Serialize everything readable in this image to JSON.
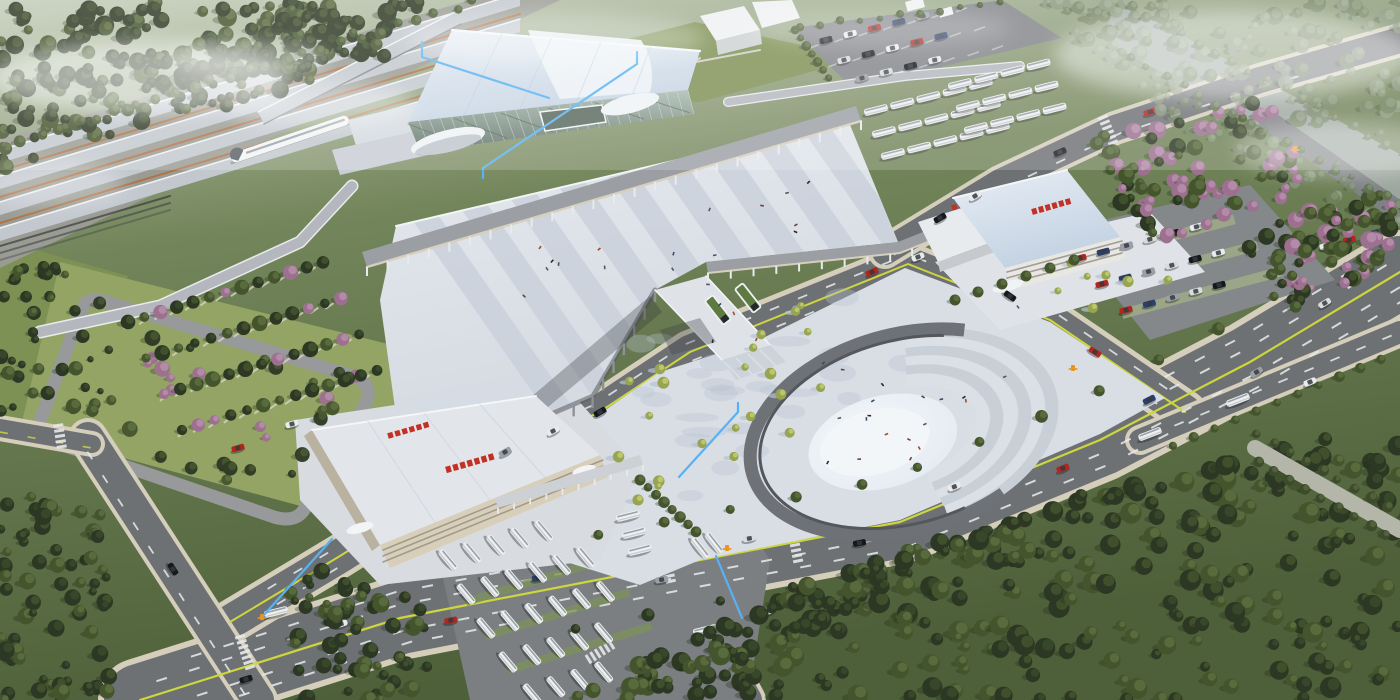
{
  "scene": {
    "title": "Aerial rendering of a high-speed railway station transit hub",
    "setting": "bird's-eye architectural visualization, hazy daylight, no visible text",
    "landmarks": [
      {
        "id": "railway-platforms",
        "label": "railway platform canopies with high-speed train"
      },
      {
        "id": "station-hall",
        "label": "main station hall with pale blue roof and glass facade"
      },
      {
        "id": "pedestrian-deck",
        "label": "elevated striped pedestrian deck over frontage road"
      },
      {
        "id": "footbridge",
        "label": "pedestrian bridge with twin escalator entries"
      },
      {
        "id": "amphitheater-plaza",
        "label": "horseshoe sunken plaza with stepped terraces and light oval"
      },
      {
        "id": "bus-terminal-west",
        "label": "west bus terminal building with red roof signage"
      },
      {
        "id": "transit-center-east",
        "label": "east transit center building with red roof signage"
      },
      {
        "id": "bus-depot",
        "label": "bus depot with rows of white coaches"
      },
      {
        "id": "park-and-ride",
        "label": "car parking lots"
      },
      {
        "id": "boulevard",
        "label": "tree-lined boulevard with yellow center line"
      },
      {
        "id": "greenway",
        "label": "hazy greenway corridor, dense forests"
      }
    ],
    "annotations": {
      "leader_line_count": 5,
      "orange_marker_count": 4
    }
  },
  "palette": {
    "bg_top": "#c9d4c2",
    "bg_mid": "#75875a",
    "bg_bot": "#4e6039",
    "forest_dark": "#2c3823",
    "forest_mid": "#44552e",
    "forest_light": "#5d7040",
    "forest_haze": "#87977c",
    "tree_pink": "#9d7090",
    "sapling": "#97a452",
    "sapling_hi": "#bcc76c",
    "lawn": "#7e9154",
    "lawn_light": "#93a465",
    "road": "#6e7174",
    "road_light": "#7e8184",
    "curb": "#d4cebb",
    "sidewalk": "#cfc9b5",
    "plaza": "#d9dee5",
    "plaza_shadow": "#b7c2d1",
    "deck": "#dde1e7",
    "deck_band": "#c9d0da",
    "roof_blue": "#ccd9e7",
    "roof_bright": "#edf2f7",
    "roof_white": "#e2e6ea",
    "glass": "#8fa49a",
    "glass_dark": "#59695f",
    "canopy": "#c3c8cf",
    "canopy_dark": "#9b9fa4",
    "fascia": "#d6cfbd",
    "cream": "#d8cfba",
    "cream_dark": "#b9b2a0",
    "white_bldg": "#eff1f2",
    "white_bldg_side": "#cfd2d4",
    "red_sign": "#c23124",
    "yellow_line": "#cdd63c",
    "white_line": "#e9ebec",
    "anno_blue": "#58b2f2",
    "marker_orange": "#e8941f",
    "train": "#f3f5f6",
    "train_nose": "#5a6168",
    "rail_orange": "#b07346",
    "track": "#3c4042",
    "oval": "#eaeff5",
    "oval_hi": "#f3f6f9",
    "water": "#a2aca9",
    "ring": "#6e7175",
    "step_a": "#c9cfd7",
    "step_b": "#dbe0e6",
    "car_colors": [
      "#16191c",
      "#e9ebed",
      "#b1271e",
      "#2c3e6b",
      "#9aa0a5",
      "#d9dbdd"
    ]
  },
  "counts": {
    "platform_canopies": 4,
    "trains": 1,
    "depot_bus_rows": 5,
    "buses_approx": 40,
    "cars_approx": 60,
    "plaza_saplings": 30,
    "leader_lines": 5,
    "orange_markers": 4
  }
}
